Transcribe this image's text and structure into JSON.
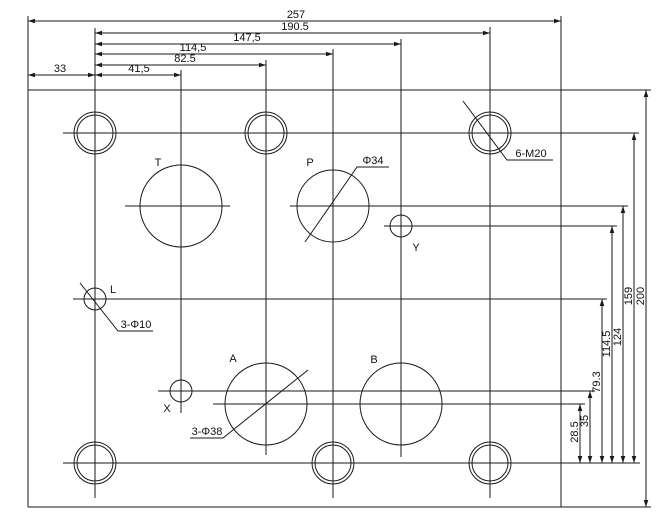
{
  "drawing": {
    "canvas": {
      "width": 666,
      "height": 527
    },
    "background_color": "#ffffff",
    "stroke_color": "#1a1a1a",
    "lines": [
      {
        "id": "plate-top-edge",
        "x1": 28,
        "y1": 90,
        "x2": 651,
        "y2": 90
      },
      {
        "id": "plate-bottom-edge",
        "x1": 28,
        "y1": 507,
        "x2": 651,
        "y2": 507
      },
      {
        "id": "plate-left-edge",
        "x1": 28,
        "y1": 16,
        "x2": 28,
        "y2": 507
      },
      {
        "id": "plate-right-edge",
        "x1": 561,
        "y1": 16,
        "x2": 561,
        "y2": 507
      },
      {
        "id": "centerline-top-bolt-row",
        "x1": 63,
        "y1": 133,
        "x2": 639,
        "y2": 133
      },
      {
        "id": "centerline-port-t",
        "x1": 125,
        "y1": 206,
        "x2": 230,
        "y2": 206
      },
      {
        "id": "centerline-port-p-extended",
        "x1": 290,
        "y1": 206,
        "x2": 628,
        "y2": 206
      },
      {
        "id": "centerline-pilot-y",
        "x1": 384,
        "y1": 226,
        "x2": 617,
        "y2": 226
      },
      {
        "id": "centerline-pilot-l",
        "x1": 73,
        "y1": 299,
        "x2": 607,
        "y2": 299
      },
      {
        "id": "centerline-pilot-x",
        "x1": 158,
        "y1": 391,
        "x2": 595,
        "y2": 391
      },
      {
        "id": "centerline-ports-ab",
        "x1": 213,
        "y1": 404,
        "x2": 585,
        "y2": 404
      },
      {
        "id": "centerline-bottom-bolt-row",
        "x1": 63,
        "y1": 463,
        "x2": 640,
        "y2": 463
      },
      {
        "id": "centerline-column-1",
        "x1": 95,
        "y1": 28,
        "x2": 95,
        "y2": 498
      },
      {
        "id": "centerline-column-2",
        "x1": 181,
        "y1": 70,
        "x2": 181,
        "y2": 413
      },
      {
        "id": "centerline-column-3",
        "x1": 266,
        "y1": 60,
        "x2": 266,
        "y2": 455
      },
      {
        "id": "centerline-column-4",
        "x1": 333,
        "y1": 49,
        "x2": 333,
        "y2": 498
      },
      {
        "id": "centerline-column-5",
        "x1": 401,
        "y1": 39,
        "x2": 401,
        "y2": 457
      },
      {
        "id": "centerline-column-6",
        "x1": 490,
        "y1": 27,
        "x2": 490,
        "y2": 498
      }
    ],
    "bolt_holes": {
      "outer_radius": 21,
      "inner_radius": 18,
      "centers": [
        [
          95,
          133
        ],
        [
          266,
          133
        ],
        [
          490,
          133
        ],
        [
          95,
          463
        ],
        [
          333,
          463
        ],
        [
          490,
          463
        ]
      ]
    },
    "port_circles": [
      {
        "id": "port-t",
        "label": "T",
        "cx": 181,
        "cy": 206,
        "r": 41,
        "lx": 158,
        "ly": 166
      },
      {
        "id": "port-p",
        "label": "P",
        "cx": 333,
        "cy": 206,
        "r": 36,
        "lx": 310,
        "ly": 166
      },
      {
        "id": "port-a",
        "label": "A",
        "cx": 266,
        "cy": 404,
        "r": 41,
        "lx": 233,
        "ly": 362
      },
      {
        "id": "port-b",
        "label": "B",
        "cx": 401,
        "cy": 404,
        "r": 41,
        "lx": 374,
        "ly": 363
      }
    ],
    "pilot_circles": [
      {
        "id": "pilot-l",
        "label": "L",
        "cx": 95,
        "cy": 299,
        "r": 11,
        "lx": 113,
        "ly": 293
      },
      {
        "id": "pilot-x",
        "label": "X",
        "cx": 181,
        "cy": 391,
        "r": 11,
        "lx": 167,
        "ly": 412
      },
      {
        "id": "pilot-y",
        "label": "Y",
        "cx": 401,
        "cy": 226,
        "r": 11,
        "lx": 416,
        "ly": 251
      }
    ],
    "dimensions_top": [
      {
        "label": "257",
        "y": 21,
        "x1": 28,
        "x2": 561,
        "tx": 296,
        "ty": 18
      },
      {
        "label": "190.5",
        "y": 33,
        "x1": 95,
        "x2": 490,
        "tx": 295,
        "ty": 30
      },
      {
        "label": "147,5",
        "y": 44,
        "x1": 95,
        "x2": 401,
        "tx": 247,
        "ty": 41
      },
      {
        "label": "114,5",
        "y": 54,
        "x1": 95,
        "x2": 333,
        "tx": 193,
        "ty": 51
      },
      {
        "label": "82.5",
        "y": 65,
        "x1": 95,
        "x2": 266,
        "tx": 185,
        "ty": 62
      },
      {
        "label": "41,5",
        "y": 75,
        "x1": 95,
        "x2": 181,
        "tx": 139,
        "ty": 72
      },
      {
        "label": "33",
        "y": 75,
        "x1": 28,
        "x2": 95,
        "tx": 60,
        "ty": 72
      }
    ],
    "dimensions_right": [
      {
        "label": "200",
        "x": 646,
        "y1": 90,
        "y2": 507,
        "tx": 644,
        "ty": 296
      },
      {
        "label": "159",
        "x": 634,
        "y1": 133,
        "y2": 463,
        "tx": 632,
        "ty": 296
      },
      {
        "label": "124",
        "x": 623,
        "y1": 206,
        "y2": 463,
        "tx": 621,
        "ty": 337
      },
      {
        "label": "114.5",
        "x": 612,
        "y1": 226,
        "y2": 463,
        "tx": 610,
        "ty": 344
      },
      {
        "label": "79.3",
        "x": 602,
        "y1": 299,
        "y2": 463,
        "tx": 600,
        "ty": 382
      },
      {
        "label": "35",
        "x": 590,
        "y1": 391,
        "y2": 463,
        "tx": 588,
        "ty": 421
      },
      {
        "label": "28.5",
        "x": 580,
        "y1": 404,
        "y2": 463,
        "tx": 578,
        "ty": 432
      }
    ],
    "leaders": [
      {
        "id": "note-6-m20",
        "text": "6-M20",
        "points": [
          [
            463,
            101
          ],
          [
            507,
            160
          ],
          [
            553,
            160
          ]
        ],
        "tx": 531,
        "ty": 157
      },
      {
        "id": "note-phi34",
        "text": "Φ34",
        "points": [
          [
            305,
            242
          ],
          [
            357,
            167
          ],
          [
            389,
            167
          ]
        ],
        "tx": 373,
        "ty": 164
      },
      {
        "id": "note-3-phi10",
        "text": "3-Φ10",
        "points": [
          [
            80,
            283
          ],
          [
            118,
            331
          ],
          [
            153,
            331
          ]
        ],
        "tx": 136,
        "ty": 328
      },
      {
        "id": "note-3-phi38",
        "text": "3-Φ38",
        "points": [
          [
            308,
            370
          ],
          [
            223,
            438
          ],
          [
            190,
            438
          ]
        ],
        "tx": 207,
        "ty": 435
      }
    ]
  }
}
